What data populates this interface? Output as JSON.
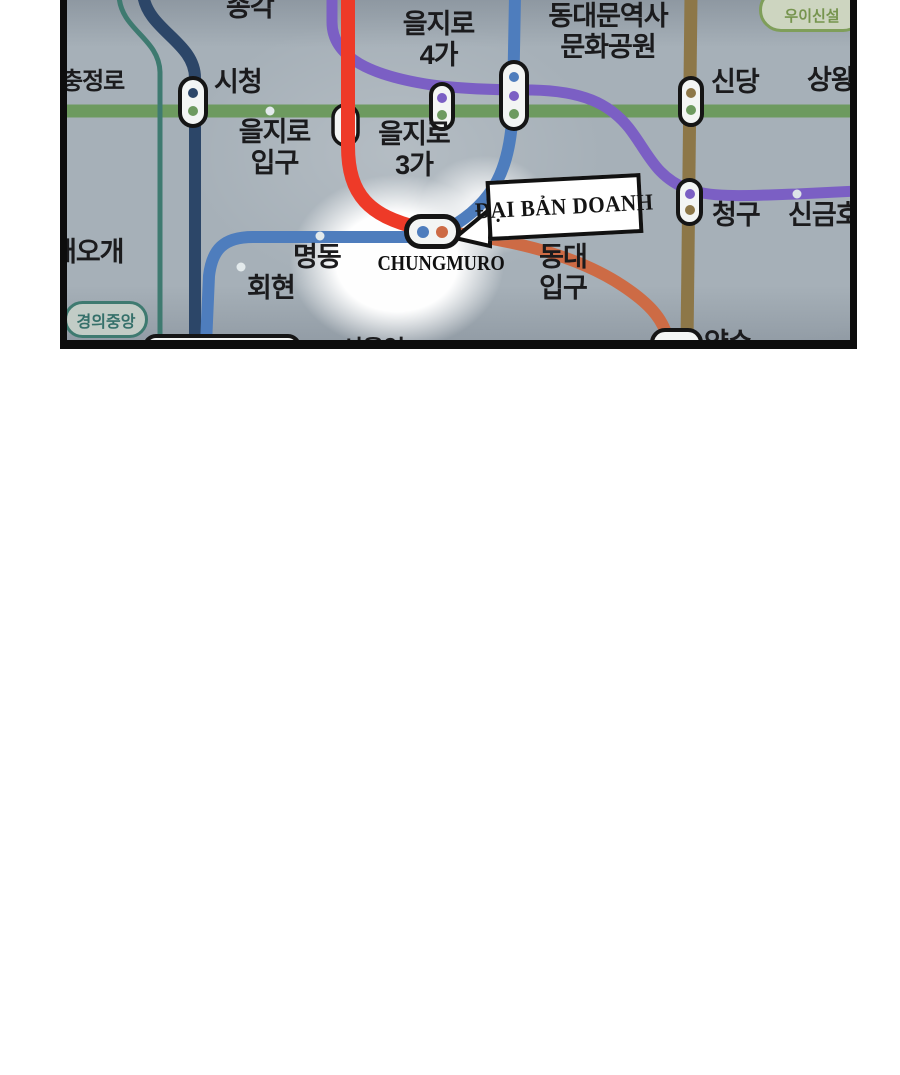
{
  "panel": {
    "type": "manhwa panel - photographed Seoul subway map",
    "background": "#a6b0b8",
    "border_color": "#0d0d0d",
    "glow": "white spotlight centered on Chungmuro station"
  },
  "map": {
    "lines": {
      "line1": {
        "name": "line-1-navy",
        "color": "#2c4668"
      },
      "line2": {
        "name": "line-2-green",
        "color": "#6d9a5f"
      },
      "line3_highlight": {
        "name": "line-3-highlighted-red",
        "color": "#ee3a28"
      },
      "line3": {
        "name": "line-3-orange",
        "color": "#cd6b45"
      },
      "line4": {
        "name": "line-4-blue",
        "color": "#4e7dbd"
      },
      "line5": {
        "name": "line-5-purple",
        "color": "#7b5fc4"
      },
      "line6": {
        "name": "line-6-brown",
        "color": "#8d7748"
      },
      "gyeongui_line": {
        "name": "gyeongui-jungang-teal",
        "color": "#3e7a70"
      }
    },
    "stations": {
      "jonggak": {
        "label": "종각"
      },
      "chungjeongno": {
        "label": "충정로"
      },
      "city_hall": {
        "label": "시청"
      },
      "euljiro_ipgu": {
        "line1": "을지로",
        "line2": "입구"
      },
      "euljiro_3ga": {
        "line1": "을지로",
        "line2": "3가"
      },
      "euljiro_4ga": {
        "line1": "을지로",
        "line2": "4가"
      },
      "ddm_history_culture_park": {
        "line1": "동대문역사",
        "line2": "문화공원"
      },
      "sindang": {
        "label": "신당"
      },
      "sangwangsimni": {
        "label": "상왕"
      },
      "cheonggu": {
        "label": "청구"
      },
      "singeumho": {
        "label": "신금호"
      },
      "dongguk_univ": {
        "line1": "동대",
        "line2": "입구"
      },
      "myeongdong": {
        "label": "명동"
      },
      "hoehyeon": {
        "label": "회현"
      },
      "aeogae": {
        "label": "애오개"
      },
      "yaksu": {
        "label": "약수"
      },
      "seoul_station": {
        "label": "서울역"
      },
      "chungmuro": {
        "label_en": "CHUNGMURO"
      }
    },
    "badges": {
      "ui_sinseol": {
        "label": "우이신설",
        "color": "#7f9e5a"
      },
      "gyeongui_jungang": {
        "label": "경의중앙",
        "color": "#3e7a70"
      }
    }
  },
  "callout": {
    "label": "ĐẠI BẢN DOANH",
    "background": "#ffffff",
    "border": "#111111",
    "points_to": "chungmuro"
  }
}
